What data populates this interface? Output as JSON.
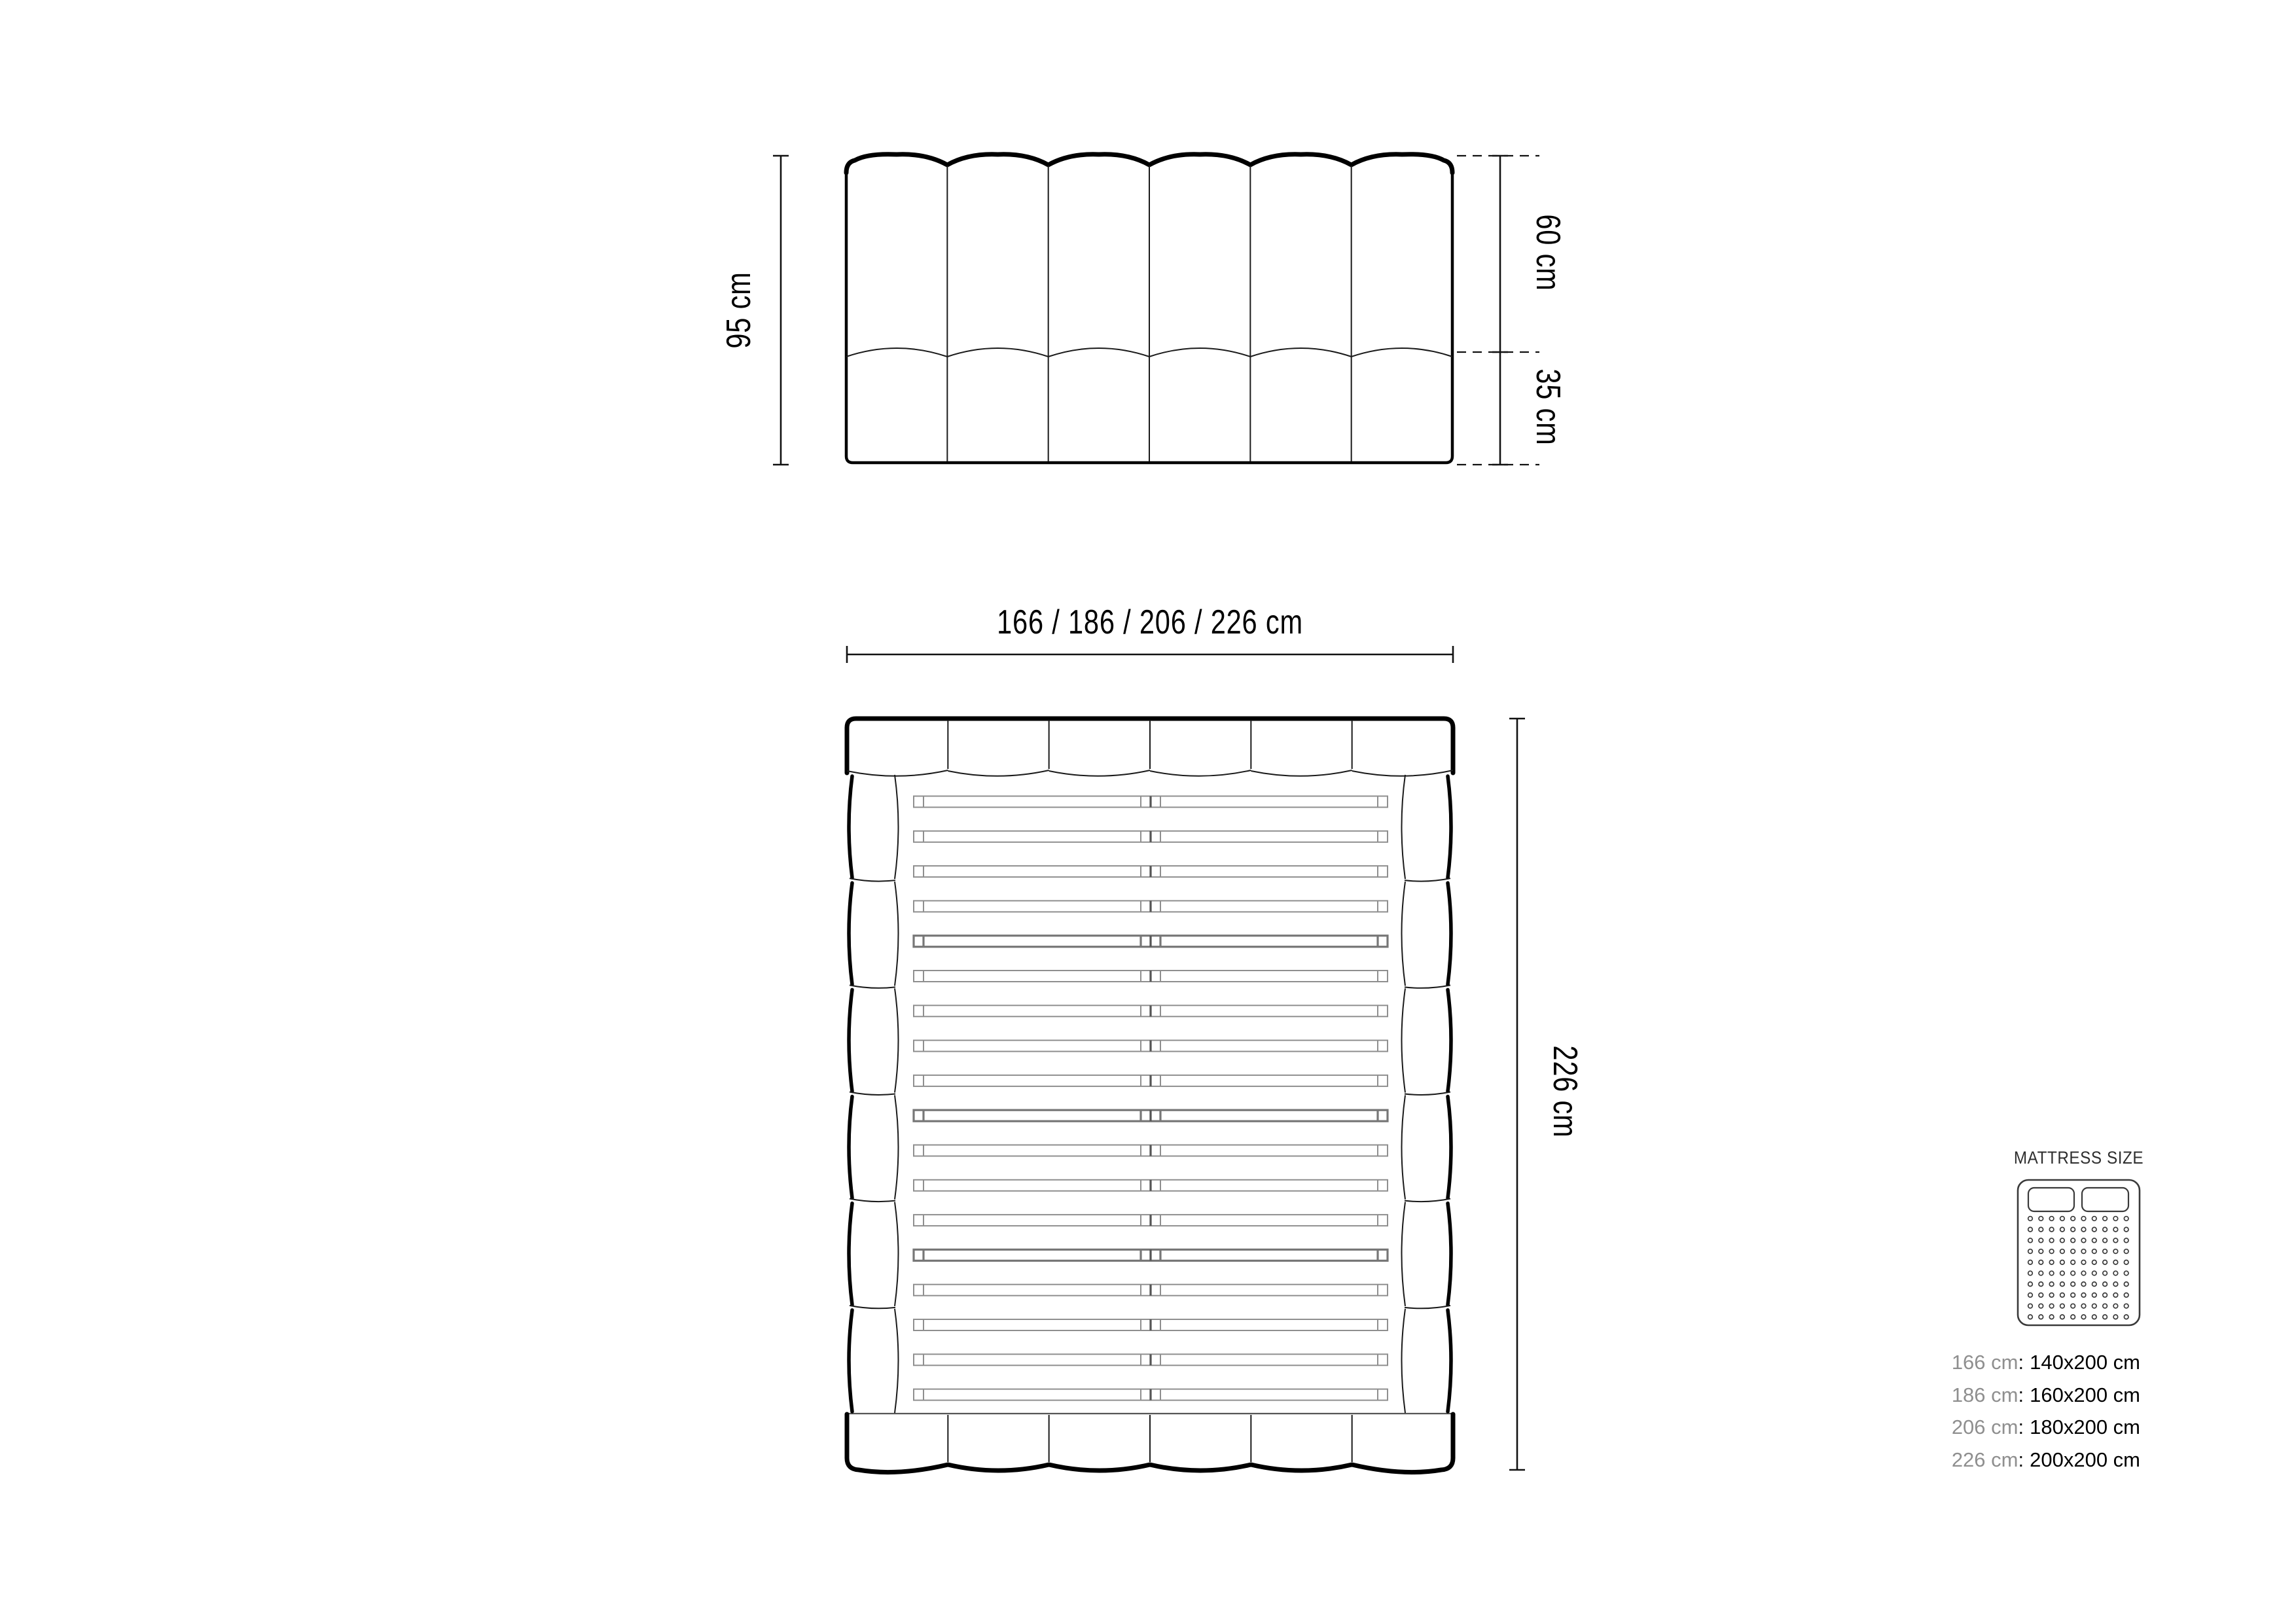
{
  "front_view": {
    "total_height": "95 cm",
    "upper_height": "60 cm",
    "lower_height": "35 cm"
  },
  "top_view": {
    "width_options": "166 / 186 / 206 / 226 cm",
    "length": "226 cm"
  },
  "legend": {
    "title": "MATTRESS SIZE",
    "separator": ":",
    "rows": [
      {
        "size": "166 cm",
        "mattress": "140x200 cm"
      },
      {
        "size": "186 cm",
        "mattress": "160x200 cm"
      },
      {
        "size": "206 cm",
        "mattress": "180x200 cm"
      },
      {
        "size": "226 cm",
        "mattress": "200x200 cm"
      }
    ]
  },
  "colors": {
    "line": "#000000",
    "slat": "#8f8f8f",
    "muted_text": "#8f8f8f",
    "text": "#000000"
  }
}
